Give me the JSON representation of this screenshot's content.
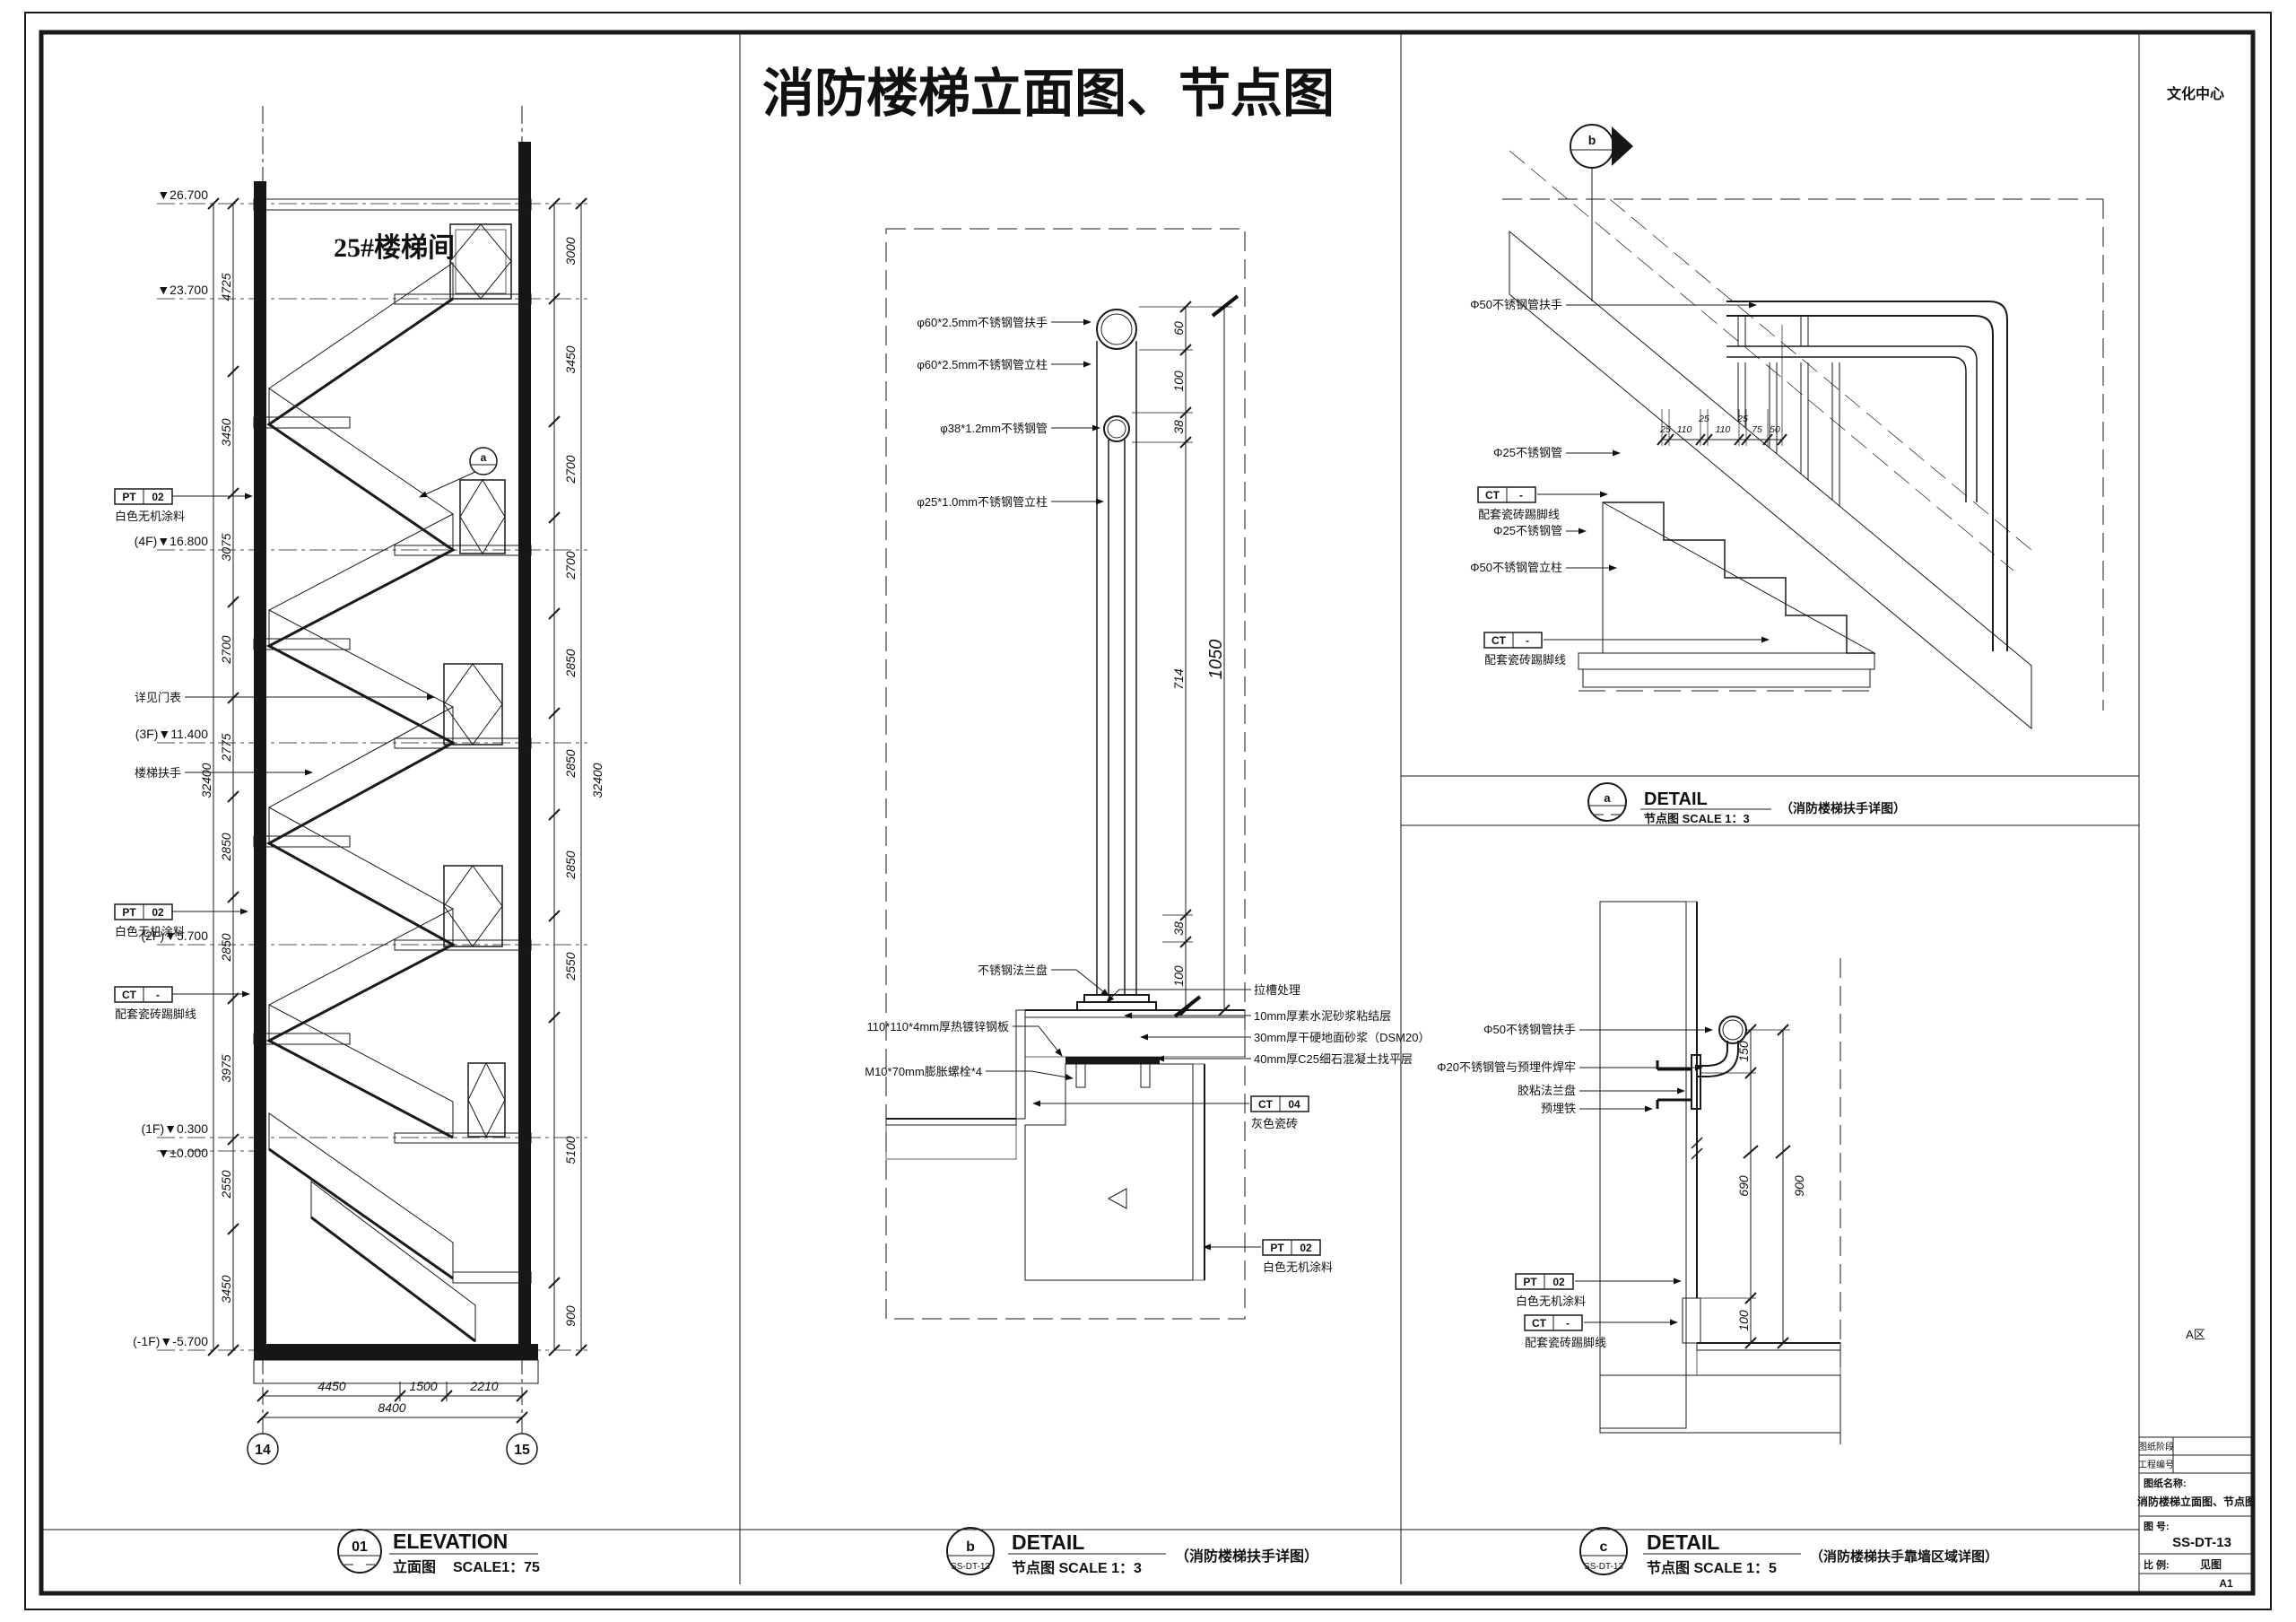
{
  "sheet": {
    "title": "消防楼梯立面图、节点图"
  },
  "titleblock": {
    "project": "文化中心",
    "zone": "A区",
    "row1_label": "图纸阶段",
    "row2_label": "工程编号",
    "name_label": "图纸名称:",
    "name_value": "消防楼梯立面图、节点图",
    "no_label": "图 号:",
    "no_value": "SS-DT-13",
    "scale_label": "比 例:",
    "scale_value": "见图",
    "size": "A1"
  },
  "elevation": {
    "room": "25#楼梯间",
    "levels": [
      "▼26.700",
      "▼23.700",
      "(4F)▼16.800",
      "(3F)▼11.400",
      "(2F)▼5.700",
      "(1F)▼0.300",
      "▼±0.000",
      "(-1F)▼-5.700"
    ],
    "dims_left": [
      "4725",
      "3450",
      "3075",
      "2700",
      "2775",
      "2850",
      "2850",
      "3975",
      "2550",
      "3450"
    ],
    "overall_left": "32400",
    "dims_right": [
      "3000",
      "3450",
      "2700",
      "2700",
      "2850",
      "2850",
      "2850",
      "2550",
      "5100",
      "900"
    ],
    "overall_right": "32400",
    "dims_bottom": [
      "4450",
      "1500",
      "2210"
    ],
    "overall_bottom": "8400",
    "grids": [
      "14",
      "15"
    ],
    "pt02": {
      "code": "PT",
      "num": "02",
      "desc": "白色无机涂料"
    },
    "ct": {
      "code": "CT",
      "num": "-",
      "desc": "配套瓷砖踢脚线"
    },
    "note_door": "详见门表",
    "note_rail": "楼梯扶手",
    "bubble_a": "a",
    "title": {
      "num": "01",
      "en": "ELEVATION",
      "cn": "立面图",
      "scale": "SCALE1：75"
    }
  },
  "detail_b": {
    "callouts_left": [
      "φ60*2.5mm不锈钢管扶手",
      "φ60*2.5mm不锈钢管立柱",
      "φ38*1.2mm不锈钢管",
      "φ25*1.0mm不锈钢管立柱",
      "不锈钢法兰盘",
      "110*110*4mm厚热镀锌钢板",
      "M10*70mm膨胀螺栓*4"
    ],
    "callouts_right": [
      "拉槽处理",
      "10mm厚素水泥砂浆粘结层",
      "30mm厚干硬地面砂浆（DSM20）",
      "40mm厚C25细石混凝土找平层"
    ],
    "ct04": {
      "code": "CT",
      "num": "04",
      "desc": "灰色瓷砖"
    },
    "pt02": {
      "code": "PT",
      "num": "02",
      "desc": "白色无机涂料"
    },
    "dims": [
      "60",
      "100",
      "38",
      "714",
      "38",
      "100"
    ],
    "overall": "1050",
    "title": {
      "num": "b",
      "ref": "SS-DT-13",
      "en": "DETAIL",
      "cn_scale": "节点图  SCALE 1：3",
      "note": "（消防楼梯扶手详图）"
    }
  },
  "detail_a": {
    "bubble": "b",
    "callouts": [
      "Φ50不锈钢管扶手",
      "Φ25不锈钢管",
      "Φ25不锈钢管",
      "Φ50不锈钢管立柱"
    ],
    "ct": {
      "code": "CT",
      "num": "-",
      "desc": "配套瓷砖踢脚线"
    },
    "dims": [
      "25",
      "110",
      "25",
      "110",
      "25",
      "75",
      "50"
    ],
    "title": {
      "num": "a",
      "en": "DETAIL",
      "cn_scale": "节点图  SCALE 1：3",
      "note": "（消防楼梯扶手详图）"
    }
  },
  "detail_c": {
    "callouts": [
      "Φ50不锈钢管扶手",
      "Φ20不锈钢管与预埋件焊牢",
      "胶粘法兰盘",
      "预埋铁"
    ],
    "pt02": {
      "code": "PT",
      "num": "02",
      "desc": "白色无机涂料"
    },
    "ct": {
      "code": "CT",
      "num": "-",
      "desc": "配套瓷砖踢脚线"
    },
    "dims": [
      "150",
      "690",
      "100"
    ],
    "overall": "900",
    "title": {
      "num": "c",
      "ref": "SS-DT-13",
      "en": "DETAIL",
      "cn_scale": "节点图  SCALE 1：5",
      "note": "（消防楼梯扶手靠墙区域详图）"
    }
  }
}
